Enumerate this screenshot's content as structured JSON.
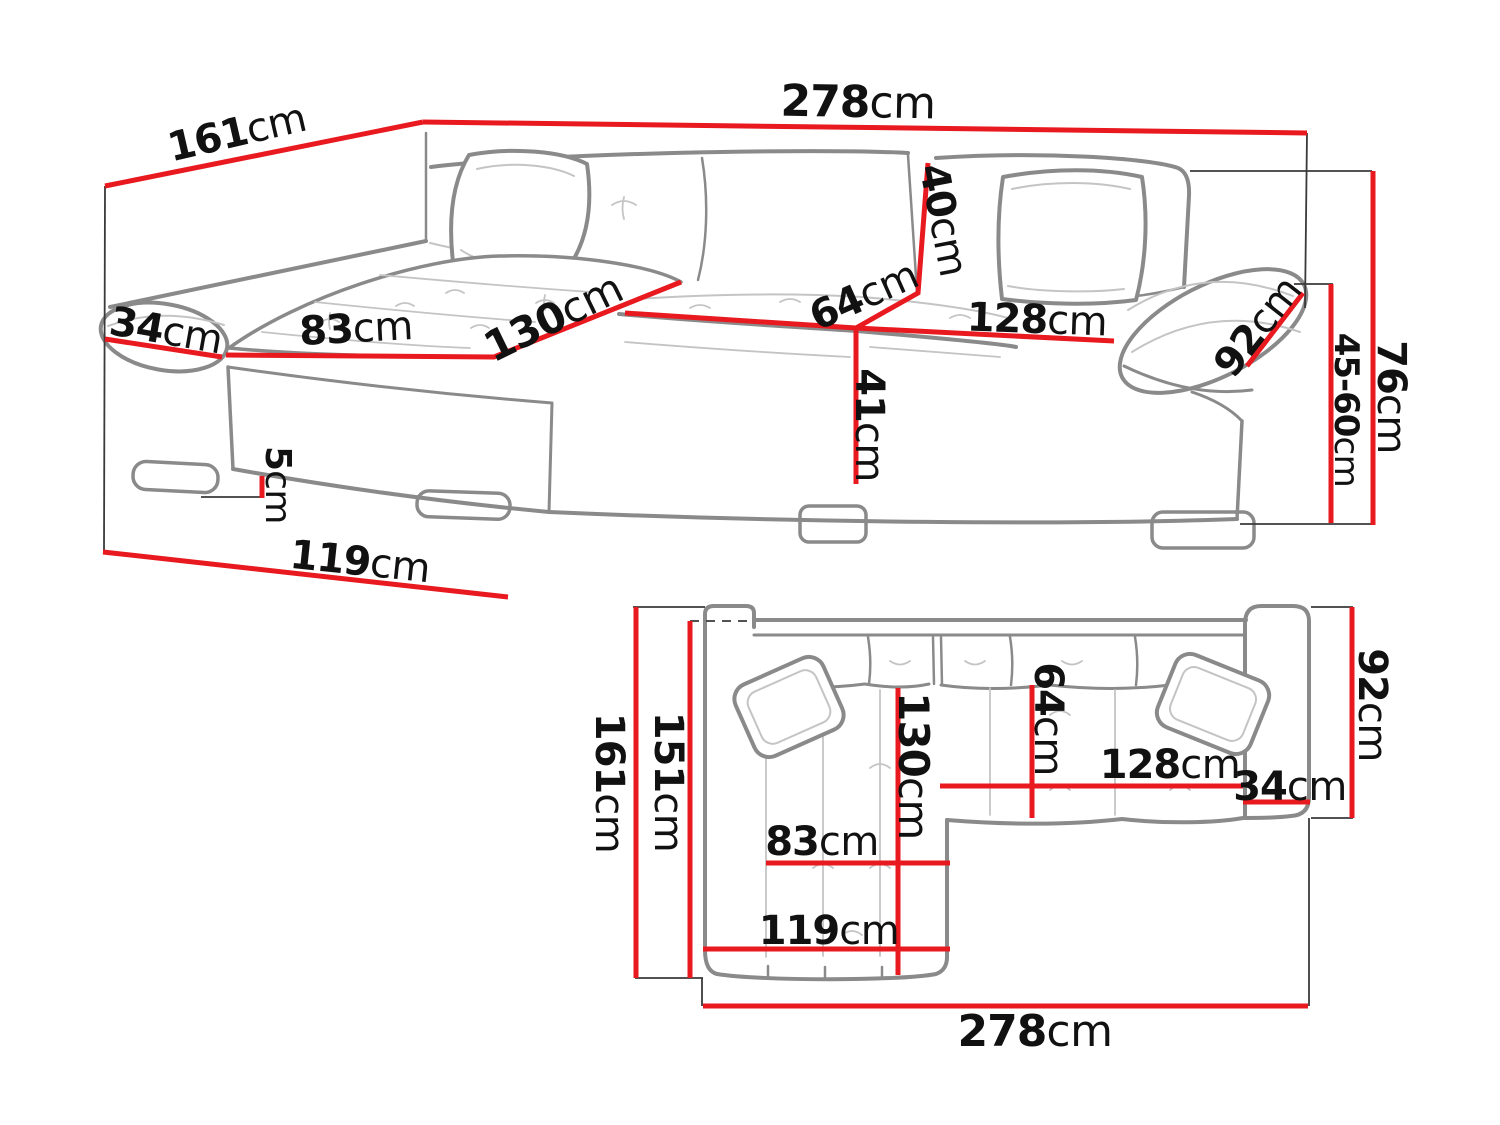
{
  "page": {
    "background": "#ffffff"
  },
  "colors": {
    "dimension_line": "#e8191f",
    "sofa_outline": "#8a8a8a",
    "sofa_detail": "#c4c4c4",
    "construction_line": "#3a3a3a",
    "label_text": "#111111"
  },
  "unit": "cm",
  "diagram": {
    "subject": "corner-sofa-dimension-drawing",
    "views": {
      "perspective": {
        "name": "perspective-view",
        "labels": [
          {
            "id": "total-width",
            "value": "278",
            "unit": "cm"
          },
          {
            "id": "chaise-depth",
            "value": "161",
            "unit": "cm"
          },
          {
            "id": "left-armrest-width",
            "value": "34",
            "unit": "cm"
          },
          {
            "id": "chaise-seat-width",
            "value": "83",
            "unit": "cm"
          },
          {
            "id": "chaise-seat-length",
            "value": "130",
            "unit": "cm"
          },
          {
            "id": "seat-depth",
            "value": "64",
            "unit": "cm"
          },
          {
            "id": "backrest-height",
            "value": "40",
            "unit": "cm"
          },
          {
            "id": "seat-width",
            "value": "128",
            "unit": "cm"
          },
          {
            "id": "armrest-length",
            "value": "92",
            "unit": "cm"
          },
          {
            "id": "seat-height",
            "value": "41",
            "unit": "cm"
          },
          {
            "id": "leg-height",
            "value": "5",
            "unit": "cm"
          },
          {
            "id": "chaise-side-length",
            "value": "119",
            "unit": "cm"
          },
          {
            "id": "total-height",
            "value": "76",
            "unit": "cm"
          },
          {
            "id": "armrest-height",
            "value": "45-60",
            "unit": "cm"
          }
        ]
      },
      "plan": {
        "name": "top-view",
        "labels": [
          {
            "id": "total-depth",
            "value": "161",
            "unit": "cm"
          },
          {
            "id": "inner-depth",
            "value": "151",
            "unit": "cm"
          },
          {
            "id": "chaise-length",
            "value": "130",
            "unit": "cm"
          },
          {
            "id": "seat-depth",
            "value": "64",
            "unit": "cm"
          },
          {
            "id": "armrest-depth",
            "value": "92",
            "unit": "cm"
          },
          {
            "id": "seat-width",
            "value": "128",
            "unit": "cm"
          },
          {
            "id": "armrest-width",
            "value": "34",
            "unit": "cm"
          },
          {
            "id": "chaise-seat-width",
            "value": "83",
            "unit": "cm"
          },
          {
            "id": "chaise-outer-width",
            "value": "119",
            "unit": "cm"
          },
          {
            "id": "total-width",
            "value": "278",
            "unit": "cm"
          }
        ]
      }
    }
  }
}
